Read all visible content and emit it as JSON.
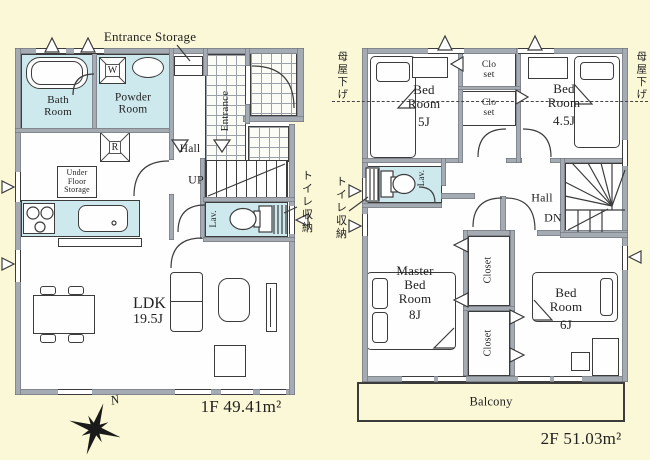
{
  "palette": {
    "background": "#fbf8d7",
    "wall": "#a5abb2",
    "wet_area": "#cde9ee",
    "line": "#3c3c3c"
  },
  "floor1": {
    "labels": {
      "entrance_storage": "Entrance Storage",
      "bath": "Bath Room",
      "powder": "Powder Room",
      "washer": "W",
      "fridge": "R",
      "hall": "Hall",
      "entrance": "Entrance",
      "up": "UP",
      "under_floor_storage": "Under Floor Storage",
      "lav": "Lav.",
      "toilet_storage": "トイレ収納",
      "ldk": "LDK",
      "ldk_size": "19.5J",
      "area": "1F 49.41m²",
      "north": "N"
    }
  },
  "floor2": {
    "labels": {
      "bed5": "Bed Room",
      "bed5_size": "5J",
      "closet_upper": "Clo set",
      "closet_lower": "Clo set",
      "bed45": "Bed Room",
      "bed45_size": "4.5J",
      "eaves_left": "母屋下げ",
      "eaves_right": "母屋下げ",
      "lav": "Lav.",
      "toilet_storage": "トイレ収納",
      "hall": "Hall",
      "down": "DN",
      "master": "Master Bed Room",
      "master_size": "8J",
      "closet_a": "Closet",
      "closet_b": "Closet",
      "bed6": "Bed Room",
      "bed6_size": "6J",
      "balcony": "Balcony",
      "area": "2F 51.03m²"
    }
  }
}
